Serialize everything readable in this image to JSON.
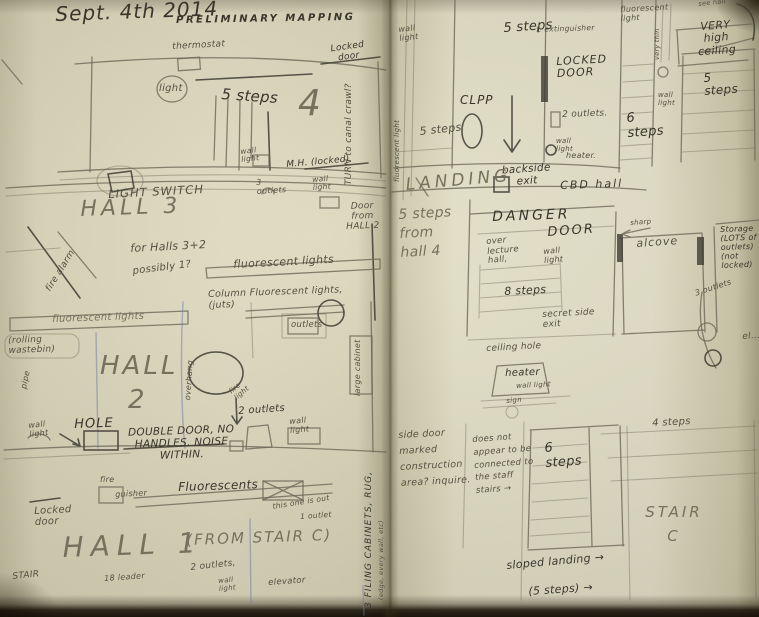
{
  "colors": {
    "paper": "#e2dfc5",
    "pencil": "#6b6857",
    "ink": "#3e3c33",
    "blue_pen": "#7078a8"
  },
  "pages": {
    "left": {
      "header": {
        "date": "Sept. 4th 2014",
        "title": "PRELIMINARY MAPPING"
      },
      "hall4": {
        "thermostat": "thermostat",
        "light": "light",
        "steps": "5 steps",
        "number": "4",
        "locked_door": "Locked door",
        "turn_note": "TURN to canal crawl?",
        "wall_light": "wall light",
        "mh_locked": "M.H. (locked)"
      },
      "hall3": {
        "outlets": "3 outlets",
        "wall_light": "wall light",
        "light_switch": "LIGHT SWITCH",
        "name": "HALL  3",
        "for_halls": "for Halls 3+2",
        "possibly": "possibly 1?",
        "fire_alarm": "fire alarm",
        "door_from": "Door from HALL 2",
        "fluorescent": "fluorescent lights"
      },
      "hall2": {
        "fluorescent": "fluorescent lights",
        "wastebin": "(rolling wastebin)",
        "column_note": "Column Fluorescent lights, (juts)",
        "outlets_box": "outlets",
        "cabinet": "large cabinet",
        "pipe": "pipe",
        "name": "HALL",
        "number": "2",
        "overhang": "overhang",
        "fire_light": "fire light",
        "wall_light_left": "wall light",
        "hole": "HOLE",
        "door_note": "DOUBLE DOOR, NO HANDLES. NOISE WITHIN.",
        "outlets2": "2 outlets",
        "wall_light_right": "wall light"
      },
      "hall1": {
        "ext_top": "fire",
        "ext_bottom": "guisher",
        "fluorescents": "Fluorescents",
        "this_one": "this one is out",
        "one_outlet": "1 outlet",
        "locked_door": "Locked door",
        "name": "HALL  1",
        "from_stair": "(FROM STAIR  C)",
        "stair": "STAIR",
        "leader": "18 leader",
        "outlets2": "2 outlets,",
        "wall_light": "wall light",
        "elevator": "elevator"
      },
      "margin": {
        "filing": "3 FILING CABINETS, RUG,",
        "filing_small": "(edge, every wall, etc)"
      }
    },
    "right": {
      "landing": {
        "wall_light": "wall light",
        "steps_top": "5 steps",
        "extinguisher": "f. extinguisher",
        "locked_door": "LOCKED DOOR",
        "clpp": "CLPP",
        "steps_left": "5 steps",
        "outlets2": "2 outlets.",
        "wall_light2": "wall light",
        "heater": "heater.",
        "backside": "backside exit",
        "name": "LANDING",
        "cbd": "CBD  hall",
        "fluor_vert": "fluorescent light"
      },
      "stairs_top": {
        "fluor": "fluorescent light",
        "very_thin": "very thin",
        "wall_light": "wall light",
        "very_high": "VERY high ceiling",
        "see_hall": "see hall",
        "steps6": "6 steps",
        "steps5": "5 steps"
      },
      "danger": {
        "from_hall": "5 steps from hall 4",
        "danger": "DANGER",
        "door": "DOOR",
        "over_lecture": "over lecture hall,",
        "wall_light": "wall light",
        "steps8": "8 steps",
        "secret": "secret side exit",
        "sharp": "sharp",
        "alcove": "alcove",
        "storage": "Storage (LOTS of outlets) (not locked)",
        "outlets3": "3 outlets",
        "elev": "el…"
      },
      "middle": {
        "ceiling_hole": "ceiling hole",
        "heater": "heater",
        "wall_light": "wall light",
        "sign": "sign",
        "steps4": "4 steps"
      },
      "bottom": {
        "side_door": "side door marked construction area? inquire.",
        "not_connected": "does not appear to be connected to the staff stairs →",
        "steps6": "6 steps",
        "stair_c": "STAIR  C",
        "sloped": "sloped landing →",
        "five_steps": "(5 steps) →"
      }
    }
  }
}
